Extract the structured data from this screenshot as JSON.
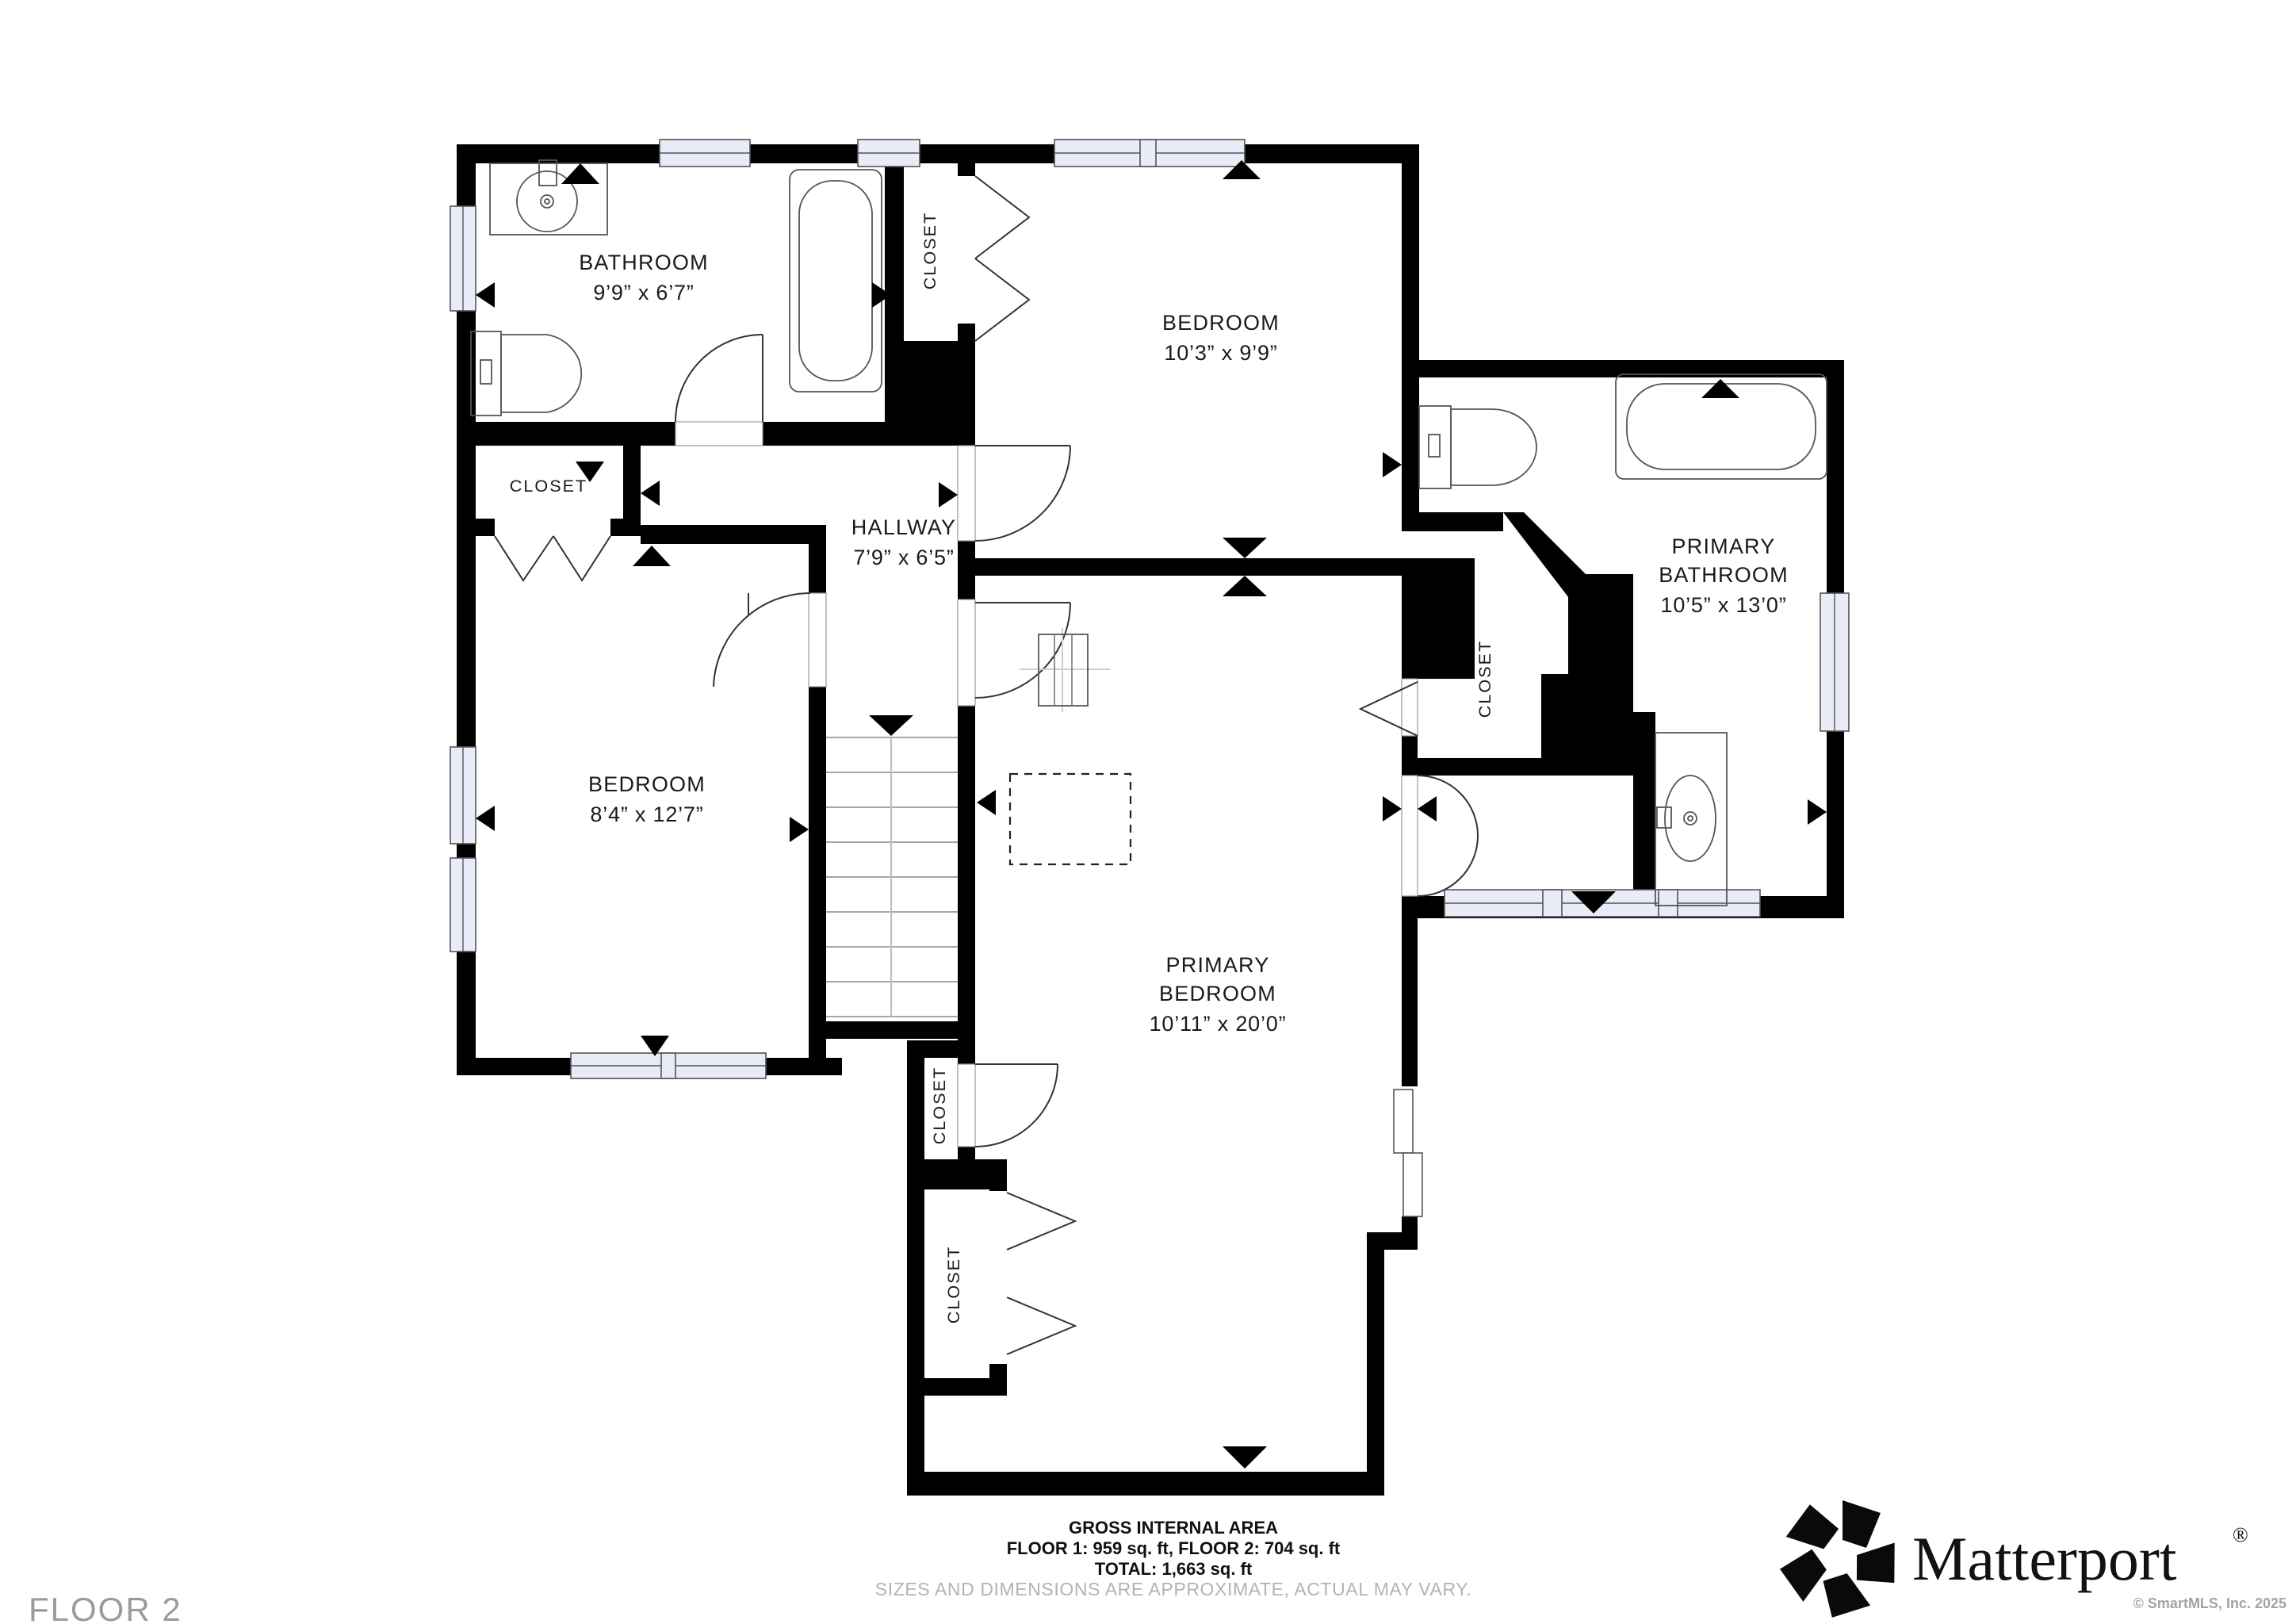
{
  "floor_label": "FLOOR 2",
  "rooms": {
    "bathroom": {
      "name": "BATHROOM",
      "dims": "9’9” x 6’7”"
    },
    "bedroom_top": {
      "name": "BEDROOM",
      "dims": "10’3” x 9’9”"
    },
    "hallway": {
      "name": "HALLWAY",
      "dims": "7’9” x 6’5”"
    },
    "bedroom_left": {
      "name": "BEDROOM",
      "dims": "8’4” x 12’7”"
    },
    "primary_bedroom": {
      "line1": "PRIMARY",
      "line2": "BEDROOM",
      "dims": "10’11” x 20’0”"
    },
    "primary_bathroom": {
      "line1": "PRIMARY",
      "line2": "BATHROOM",
      "dims": "10’5” x 13’0”"
    }
  },
  "closets": {
    "top": "CLOSET",
    "left": "CLOSET",
    "primary": "CLOSET",
    "small": "CLOSET",
    "big": "CLOSET"
  },
  "footer": {
    "area_title": "GROSS INTERNAL AREA",
    "area_floors": "FLOOR 1: 959 sq. ft, FLOOR 2: 704 sq. ft",
    "area_total": "TOTAL: 1,663 sq. ft",
    "disclaimer": "SIZES AND DIMENSIONS ARE APPROXIMATE, ACTUAL MAY VARY."
  },
  "branding": {
    "logo_text": "Matterport",
    "registered": "®",
    "copyright": "© SmartMLS, Inc.  2025"
  },
  "colors": {
    "wall": "#000000",
    "window_fill": "#e9ebf7",
    "label_text": "#1a1a1a",
    "muted_text": "#9b9b9b",
    "disclaimer_text": "#b3b3b3"
  }
}
